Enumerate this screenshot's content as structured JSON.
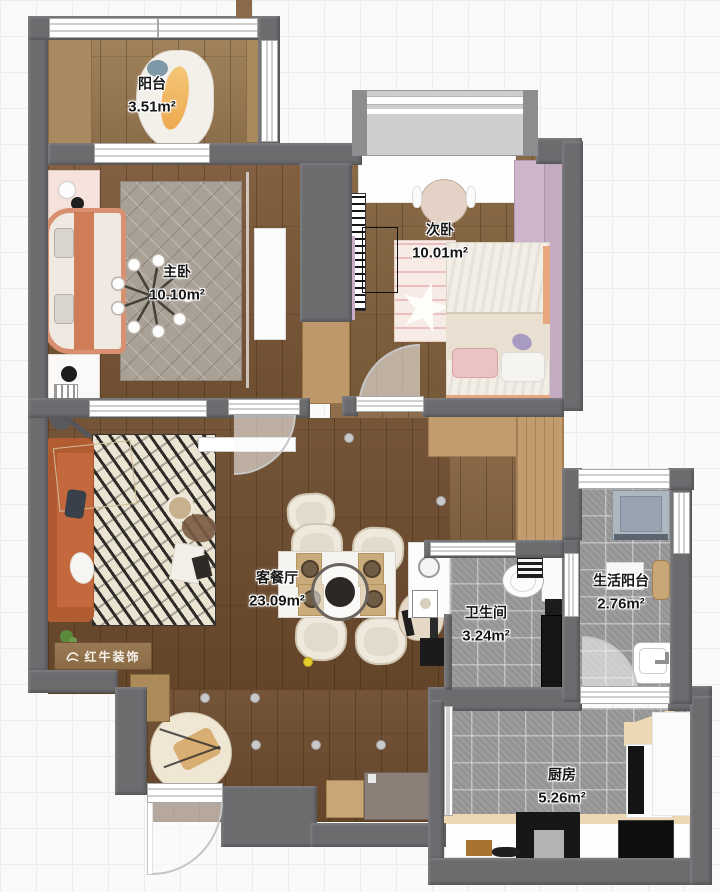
{
  "plan": {
    "brand": {
      "logo_text": "红牛装饰"
    },
    "rooms": [
      {
        "id": "balcony",
        "name": "阳台",
        "area": "3.51m²"
      },
      {
        "id": "master_bedroom",
        "name": "主卧",
        "area": "10.10m²"
      },
      {
        "id": "second_bedroom",
        "name": "次卧",
        "area": "10.01m²"
      },
      {
        "id": "living_dining",
        "name": "客餐厅",
        "area": "23.09m²"
      },
      {
        "id": "bathroom",
        "name": "卫生间",
        "area": "3.24m²"
      },
      {
        "id": "utility_balcony",
        "name": "生活阳台",
        "area": "2.76m²"
      },
      {
        "id": "kitchen",
        "name": "厨房",
        "area": "5.26m²"
      }
    ],
    "colors": {
      "wall": "#6c6c6f",
      "wood_floor": "#6e4c2e",
      "tile_floor": "#9c9c9c",
      "sofa_orange": "#c4683d",
      "wardrobe_purple": "#cdb6cc",
      "bed_accent_salmon": "#e8a87e",
      "logo_wood": "#93744f"
    }
  }
}
